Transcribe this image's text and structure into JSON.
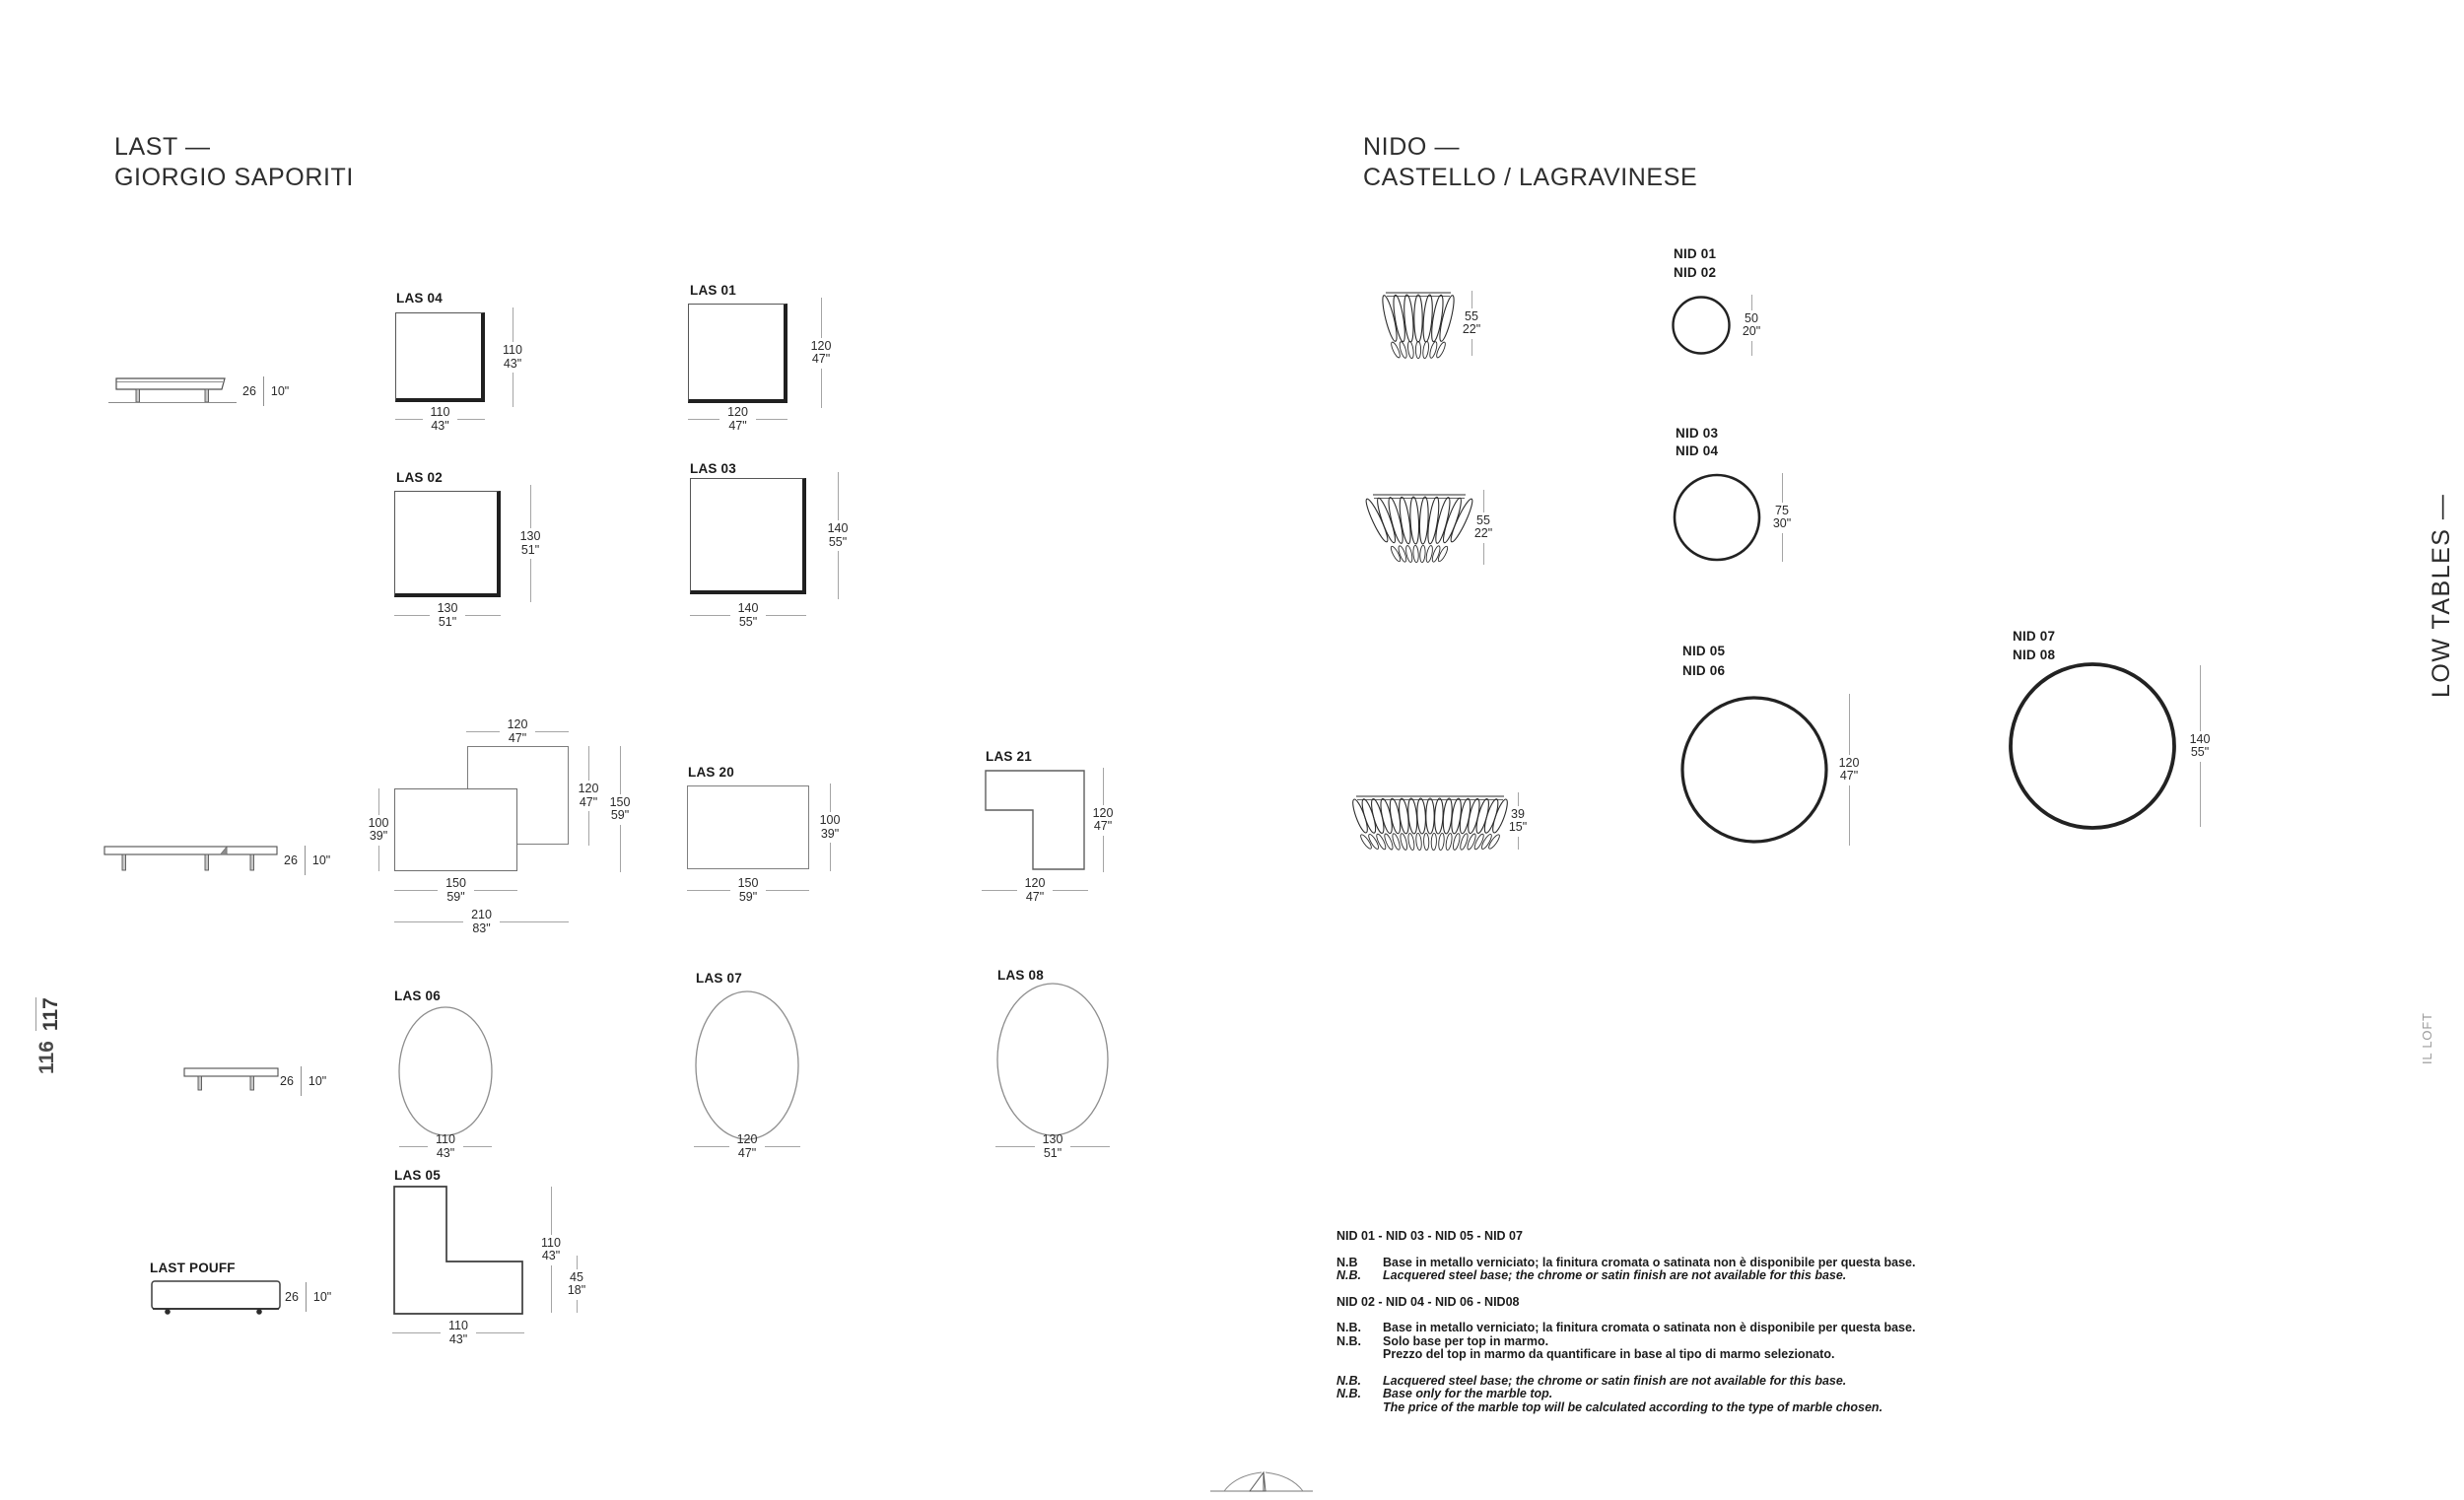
{
  "titles": {
    "last": {
      "line1": "LAST —",
      "line2": "GIORGIO SAPORITI"
    },
    "nido": {
      "line1": "NIDO —",
      "line2": "CASTELLO / LAGRAVINESE"
    }
  },
  "sidebar": {
    "category_vertical": "LOW TABLES —",
    "brand_vertical": "IL LOFT"
  },
  "pagination": {
    "page_left": "116",
    "page_right": "117"
  },
  "last_products": {
    "side_views": [
      {
        "id": "side-view-top",
        "height_cm": "26",
        "height_in": "10\""
      },
      {
        "id": "side-view-middle",
        "height_cm": "26",
        "height_in": "10\""
      },
      {
        "id": "side-view-bottom",
        "height_cm": "26",
        "height_in": "10\""
      }
    ],
    "pouff": {
      "label": "LAST POUFF",
      "height_cm": "26",
      "height_in": "10\""
    },
    "squares": [
      {
        "id": "las-04",
        "label": "LAS 04",
        "w": [
          "110",
          "43\""
        ],
        "h": [
          "110",
          "43\""
        ]
      },
      {
        "id": "las-01",
        "label": "LAS 01",
        "w": [
          "120",
          "47\""
        ],
        "h": [
          "120",
          "47\""
        ]
      },
      {
        "id": "las-02",
        "label": "LAS 02",
        "w": [
          "130",
          "51\""
        ],
        "h": [
          "130",
          "51\""
        ]
      },
      {
        "id": "las-03",
        "label": "LAS 03",
        "w": [
          "140",
          "55\""
        ],
        "h": [
          "140",
          "55\""
        ]
      }
    ],
    "composition": {
      "top": [
        "120",
        "47\""
      ],
      "left": [
        "100",
        "39\""
      ],
      "inner_right": [
        "120",
        "47\""
      ],
      "outer_right": [
        "150",
        "59\""
      ],
      "bottom_front": [
        "150",
        "59\""
      ],
      "bottom_total": [
        "210",
        "83\""
      ]
    },
    "rect": {
      "id": "las-20",
      "label": "LAS 20",
      "w": [
        "150",
        "59\""
      ],
      "h": [
        "100",
        "39\""
      ]
    },
    "l_shapes": [
      {
        "id": "las-21",
        "label": "LAS 21",
        "w": [
          "120",
          "47\""
        ],
        "h": [
          "120",
          "47\""
        ]
      },
      {
        "id": "las-05",
        "label": "LAS 05",
        "w": [
          "110",
          "43\""
        ],
        "h": [
          "110",
          "43\""
        ],
        "h2": [
          "45",
          "18\""
        ]
      }
    ],
    "circles": [
      {
        "id": "las-06",
        "label": "LAS 06",
        "w": [
          "110",
          "43\""
        ]
      },
      {
        "id": "las-07",
        "label": "LAS 07",
        "w": [
          "120",
          "47\""
        ]
      },
      {
        "id": "las-08",
        "label": "LAS 08",
        "w": [
          "130",
          "51\""
        ]
      }
    ]
  },
  "nido_products": [
    {
      "id": "nid-01-02",
      "labels": [
        "NID 01",
        "NID 02"
      ],
      "side_dim": [
        "55",
        "22\""
      ],
      "top_dim": [
        "50",
        "20\""
      ]
    },
    {
      "id": "nid-03-04",
      "labels": [
        "NID 03",
        "NID 04"
      ],
      "side_dim": [
        "55",
        "22\""
      ],
      "top_dim": [
        "75",
        "30\""
      ]
    },
    {
      "id": "nid-05-06",
      "labels": [
        "NID 05",
        "NID 06"
      ],
      "side_dim": [
        "39",
        "15\""
      ],
      "top_dim": [
        "120",
        "47\""
      ]
    },
    {
      "id": "nid-07-08",
      "labels": [
        "NID 07",
        "NID 08"
      ],
      "top_dim": [
        "140",
        "55\""
      ]
    }
  ],
  "notes": [
    {
      "type": "header",
      "text": "NID 01 - NID 03 - NID 05 - NID 07"
    },
    {
      "type": "note",
      "label": "N.B",
      "text": "Base in metallo verniciato; la finitura cromata o satinata non è disponibile per questa base.",
      "italic": false,
      "gap_before": true
    },
    {
      "type": "note",
      "label": "N.B.",
      "text": "Lacquered steel base; the chrome or satin finish are not available for this base.",
      "italic": true
    },
    {
      "type": "header",
      "text": "NID 02 - NID 04 - NID 06 - NID08",
      "gap_before": true
    },
    {
      "type": "note",
      "label": "N.B.",
      "text": "Base in metallo verniciato; la finitura cromata o satinata non è disponibile per questa base.",
      "italic": false,
      "gap_before": true
    },
    {
      "type": "note",
      "label": "N.B.",
      "text": "Solo base per top in marmo.",
      "italic": false
    },
    {
      "type": "note",
      "label": "",
      "text": "Prezzo del top in marmo da quantificare in base al tipo di marmo selezionato.",
      "italic": false
    },
    {
      "type": "note",
      "label": "N.B.",
      "text": "Lacquered steel base; the chrome or satin finish are not available for this base.",
      "italic": true,
      "gap_before": true
    },
    {
      "type": "note",
      "label": "N.B.",
      "text": "Base only for the marble top.",
      "italic": true
    },
    {
      "type": "note",
      "label": "",
      "text": "The price of the marble top will be calculated according to the type of marble chosen.",
      "italic": true
    }
  ]
}
